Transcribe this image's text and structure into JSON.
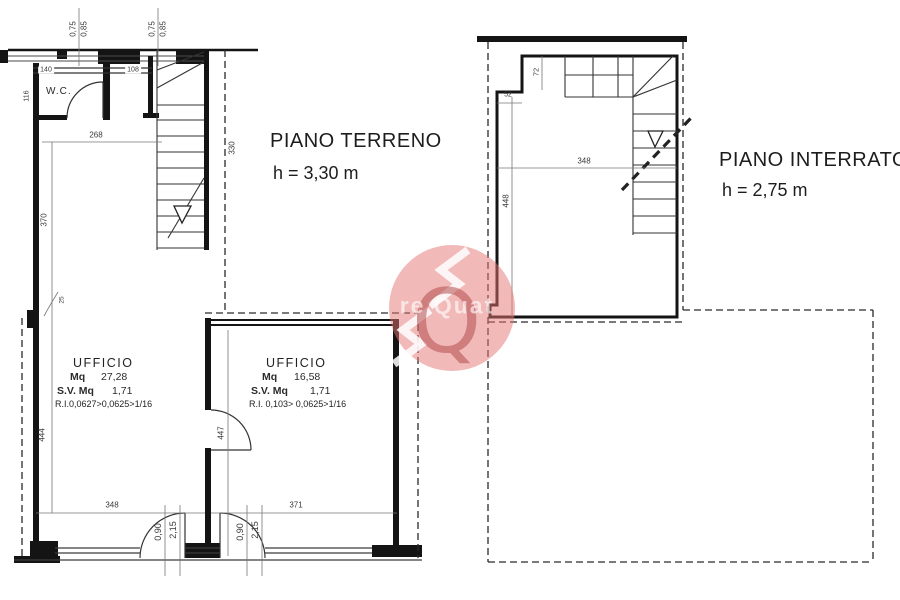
{
  "piano_terreno": {
    "title": "PIANO TERRENO",
    "height_label": "h = 3,30 m",
    "wc_label": "W.C.",
    "office_left": {
      "name": "UFFICIO",
      "mq_label": "Mq",
      "mq_value": "27,28",
      "sv_label": "S.V. Mq",
      "sv_value": "1,71",
      "ri_line": "R.I.0,0627>0,0625>1/16"
    },
    "office_right": {
      "name": "UFFICIO",
      "mq_label": "Mq",
      "mq_value": "16,58",
      "sv_label": "S.V. Mq",
      "sv_value": "1,71",
      "ri_line": "R.I. 0,103> 0,0625>1/16"
    },
    "dims": {
      "window1_a": "0,75",
      "window1_b": "0,85",
      "window2_a": "0,75",
      "window2_b": "0,85",
      "top_140": "140",
      "top_108": "108",
      "wc_116": "116",
      "hall_268": "268",
      "stair_330": "330",
      "room_370": "370",
      "notch_25": "25",
      "left_444": "444",
      "mid_447": "447",
      "bottom_348": "348",
      "bottom_371": "371",
      "door1_width": "0,90",
      "door1_height": "2,15",
      "door2_width": "0,90",
      "door2_height": "2,15"
    }
  },
  "piano_interrato": {
    "title": "PIANO INTERRATO",
    "height_label": "h = 2,75 m",
    "dims": {
      "step_72": "72",
      "step_52": "52",
      "width_348": "348",
      "depth_448": "448"
    }
  },
  "watermark": {
    "visible_text": "re Quat",
    "monogram_letter": "Q",
    "circle_color": "#e57373",
    "monogram_color": "#b34d4d"
  }
}
